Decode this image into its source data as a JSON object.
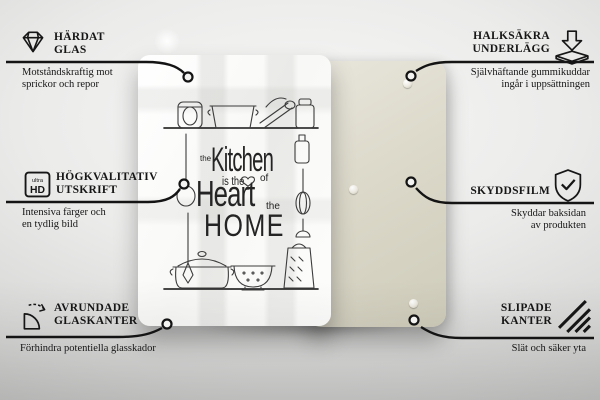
{
  "product": {
    "kind": "glass-board-front-and-back",
    "design_text": {
      "the_top": "the",
      "kitchen": "Kitchen",
      "is_the": "is the",
      "of": "of",
      "heart": "Heart",
      "the_right": "the",
      "home": "HOME"
    },
    "colors": {
      "front_board": "#ffffff",
      "back_board": "#d9d6c6",
      "line": "#141414",
      "doodle": "#3c3c3c"
    }
  },
  "callouts": {
    "top_left": {
      "icon": "diamond",
      "title_line1": "HÄRDAT",
      "title_line2": "GLAS",
      "desc_line1": "Motståndskraftig mot",
      "desc_line2": "sprickor och repor"
    },
    "mid_left": {
      "icon": "ultra-hd",
      "icon_label_top": "ultra",
      "icon_label_bottom": "HD",
      "title_line1": "HÖGKVALITATIV",
      "title_line2": "UTSKRIFT",
      "desc_line1": "Intensiva färger och",
      "desc_line2": "en tydlig bild"
    },
    "bottom_left": {
      "icon": "rounded-corner",
      "title_line1": "AVRUNDADE",
      "title_line2": "GLASKANTER",
      "desc_line1": "Förhindra potentiella glasskador"
    },
    "top_right": {
      "icon": "anti-slip-pad",
      "title_line1": "HALKSÄKRA",
      "title_line2": "UNDERLÄGG",
      "desc_line1": "Självhäftande gummikuddar",
      "desc_line2": "ingår i uppsättningen"
    },
    "mid_right": {
      "icon": "shield-check",
      "title_line1": "SKYDDSFILM",
      "desc_line1": "Skyddar baksidan",
      "desc_line2": "av produkten"
    },
    "bottom_right": {
      "icon": "ground-edges",
      "title_line1": "SLIPADE",
      "title_line2": "KANTER",
      "desc_line1": "Slät och säker yta"
    }
  }
}
